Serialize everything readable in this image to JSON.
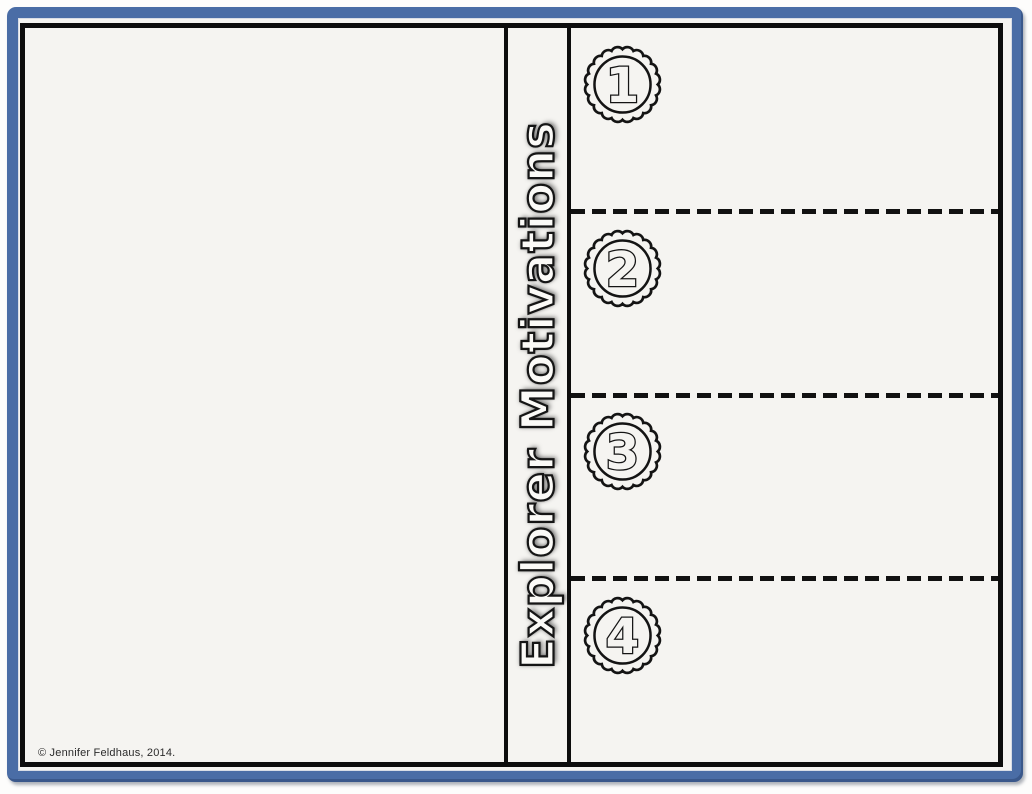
{
  "worksheet": {
    "title": "Explorer Motivations",
    "copyright": "© Jennifer Feldhaus, 2014.",
    "sections": [
      {
        "number": "1",
        "badge_icon": "scalloped-circle-number-badge"
      },
      {
        "number": "2",
        "badge_icon": "scalloped-circle-number-badge"
      },
      {
        "number": "3",
        "badge_icon": "scalloped-circle-number-badge"
      },
      {
        "number": "4",
        "badge_icon": "scalloped-circle-number-badge"
      }
    ],
    "divider_style": "dashed-cut-line",
    "colors": {
      "frame_blue": "#4a6da6",
      "ink_black": "#111111",
      "paper_white": "#f5f4f1"
    }
  }
}
